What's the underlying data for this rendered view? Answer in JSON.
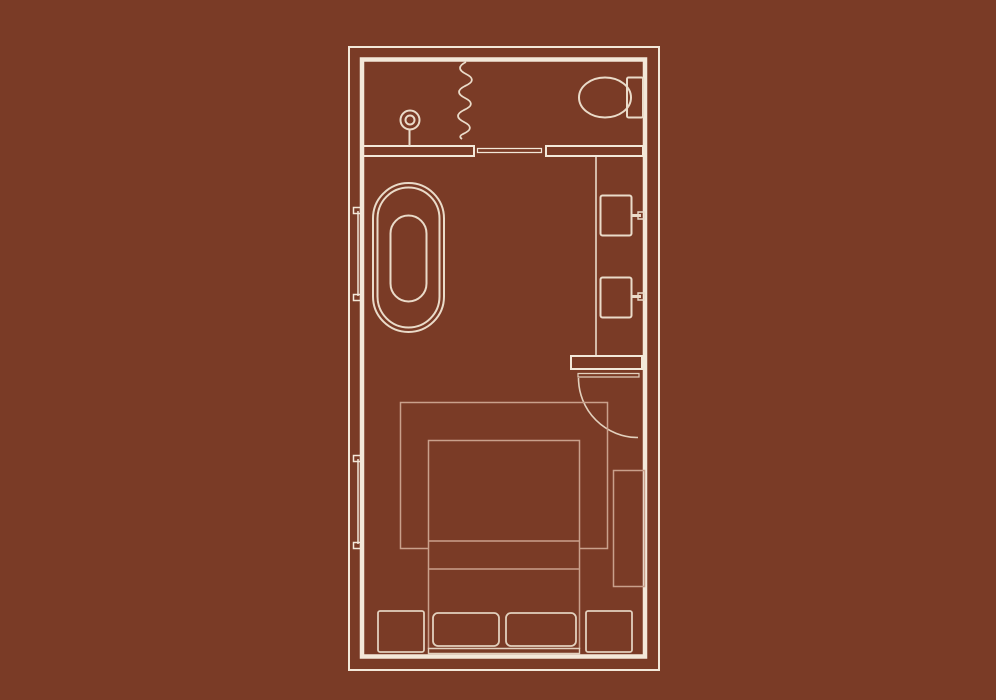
{
  "page": {
    "background_color": "#7a3b26",
    "description": "floor-plan-drawing"
  },
  "colors": {
    "wall_line": "#f3e8d9",
    "fixture_line": "#eadbc9",
    "furniture_line": "#e2d0bd",
    "soft_line": "#c9a08b"
  },
  "floor_plan": {
    "type": "room-floor-plan",
    "orientation": "portrait",
    "rooms": [
      {
        "name": "bathroom",
        "position": "top",
        "fixtures": [
          "shower-head",
          "shower-curtain",
          "toilet",
          "bathtub",
          "vanity-counter",
          "sink-upper",
          "sink-lower",
          "pocket-door"
        ]
      },
      {
        "name": "bedroom",
        "position": "bottom",
        "furniture": [
          "rug",
          "bed",
          "pillow-left",
          "pillow-right",
          "headboard",
          "nightstand-left",
          "nightstand-right",
          "bench"
        ],
        "door": "swing-door"
      }
    ],
    "window_count": 2
  }
}
